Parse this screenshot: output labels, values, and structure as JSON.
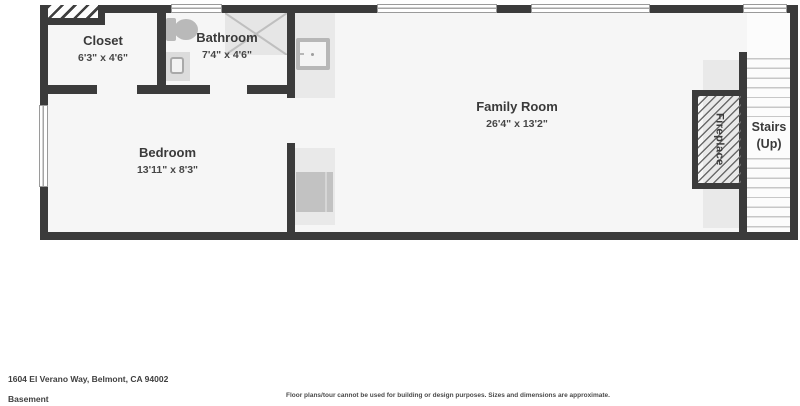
{
  "plan": {
    "rooms": [
      {
        "name": "Closet",
        "dims": "6'3\" x 4'6\""
      },
      {
        "name": "Bathroom",
        "dims": "7'4\" x 4'6\""
      },
      {
        "name": "Bedroom",
        "dims": "13'11\" x 8'3\""
      },
      {
        "name": "Family Room",
        "dims": "26'4\" x 13'2\""
      }
    ],
    "fireplace_label": "Fireplace",
    "stairs_label_line1": "Stairs",
    "stairs_label_line2": "(Up)"
  },
  "footer": {
    "address": "1604 El Verano Way, Belmont, CA 94002",
    "level": "Basement",
    "disclaimer": "Floor plans/tour cannot be used for building or design purposes. Sizes and dimensions are approximate."
  },
  "colors": {
    "wall": "#3b3b3b",
    "floor": "#f6f6f6",
    "counter": "#e9e9e9",
    "fixture": "#b9b9b9",
    "text": "#3a3a3a"
  }
}
